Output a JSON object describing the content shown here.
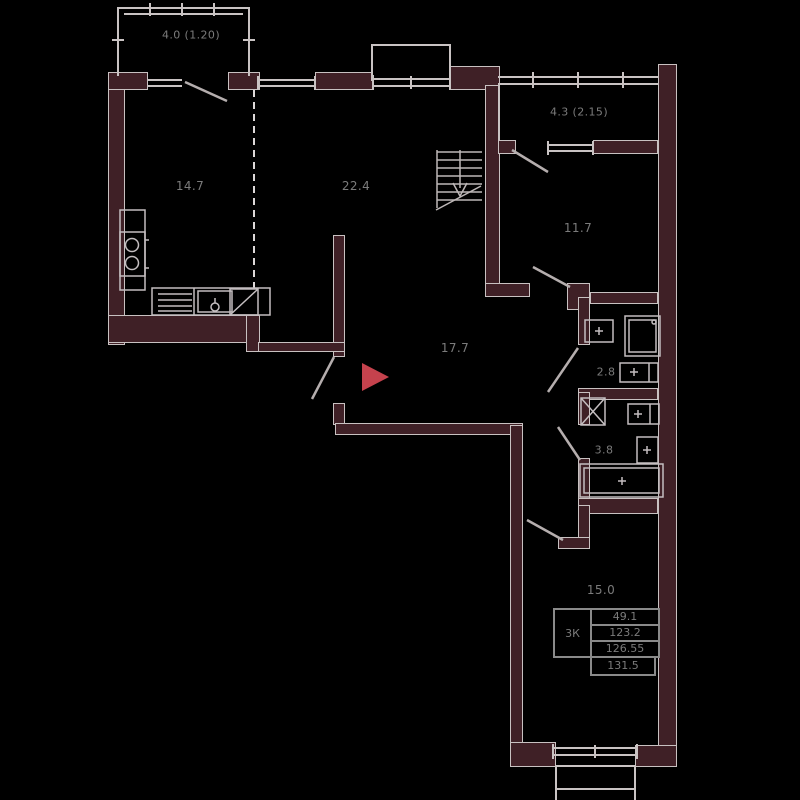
{
  "plan": {
    "colors": {
      "background": "#000000",
      "wall": "#3f2026",
      "line": "#c9c3c3",
      "text": "#7b7b7b",
      "entrance_marker": "#c5424d"
    },
    "rooms": [
      {
        "name": "balcony-top-left",
        "area_label": "4.0 (1.20)"
      },
      {
        "name": "kitchen",
        "area_label": "14.7"
      },
      {
        "name": "living-room",
        "area_label": "22.4"
      },
      {
        "name": "balcony-top-right",
        "area_label": "4.3 (2.15)"
      },
      {
        "name": "bedroom-upper-right",
        "area_label": "11.7"
      },
      {
        "name": "hall",
        "area_label": "17.7"
      },
      {
        "name": "bathroom-small",
        "area_label": "2.8"
      },
      {
        "name": "bathroom-large",
        "area_label": "3.8"
      },
      {
        "name": "bedroom-lower-right",
        "area_label": "15.0"
      }
    ],
    "info_table": {
      "apartment_type": "3К",
      "values": [
        "49.1",
        "123.2",
        "126.55",
        "131.5"
      ]
    },
    "icons": [
      "staircase-icon",
      "entrance-marker-icon",
      "stove-icon",
      "kitchen-sink-icon",
      "fridge-icon",
      "shower-icon",
      "washbasin-icon",
      "toilet-icon",
      "washing-machine-icon",
      "bathtub-icon",
      "door-swing",
      "window-glazing",
      "dashed-partition"
    ]
  }
}
